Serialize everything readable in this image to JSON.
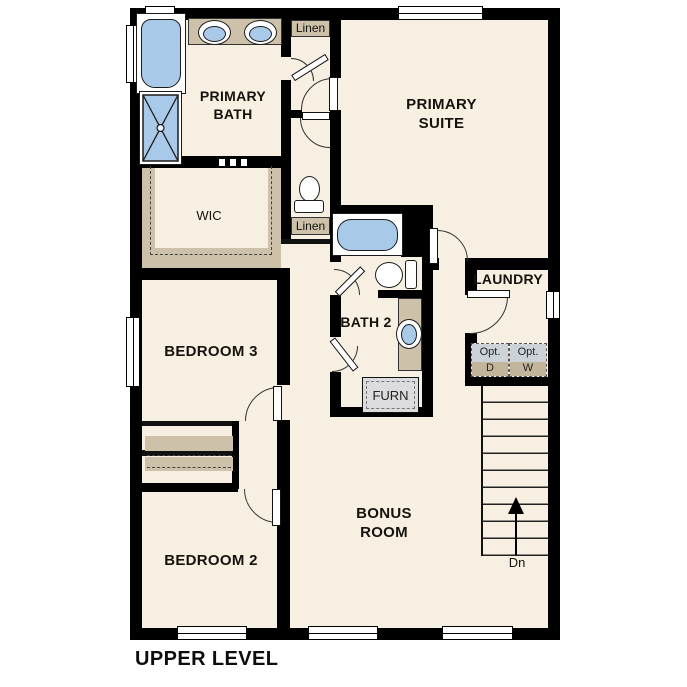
{
  "title": "UPPER LEVEL",
  "rooms": {
    "primary_bath": "PRIMARY BATH",
    "primary_suite": "PRIMARY SUITE",
    "wic": "WIC",
    "bedroom3": "BEDROOM 3",
    "bath2": "BATH 2",
    "laundry": "LAUNDRY",
    "bedroom2": "BEDROOM 2",
    "bonus_room": "BONUS ROOM"
  },
  "closets": {
    "linen_upper": "Linen",
    "linen_lower": "Linen"
  },
  "equipment": {
    "furnace": "FURN",
    "optional_dryer": {
      "top": "Opt.",
      "bottom": "D"
    },
    "optional_washer": {
      "top": "Opt.",
      "bottom": "W"
    }
  },
  "stairs": {
    "down_label": "Dn"
  },
  "colors": {
    "floor": "#f6efe2",
    "wall": "#000000",
    "shelving_tan": "#cdc1a9",
    "fixture_blue": "#a9c9e8",
    "appliance_gray": "#ccd3d8",
    "background": "#ffffff"
  }
}
